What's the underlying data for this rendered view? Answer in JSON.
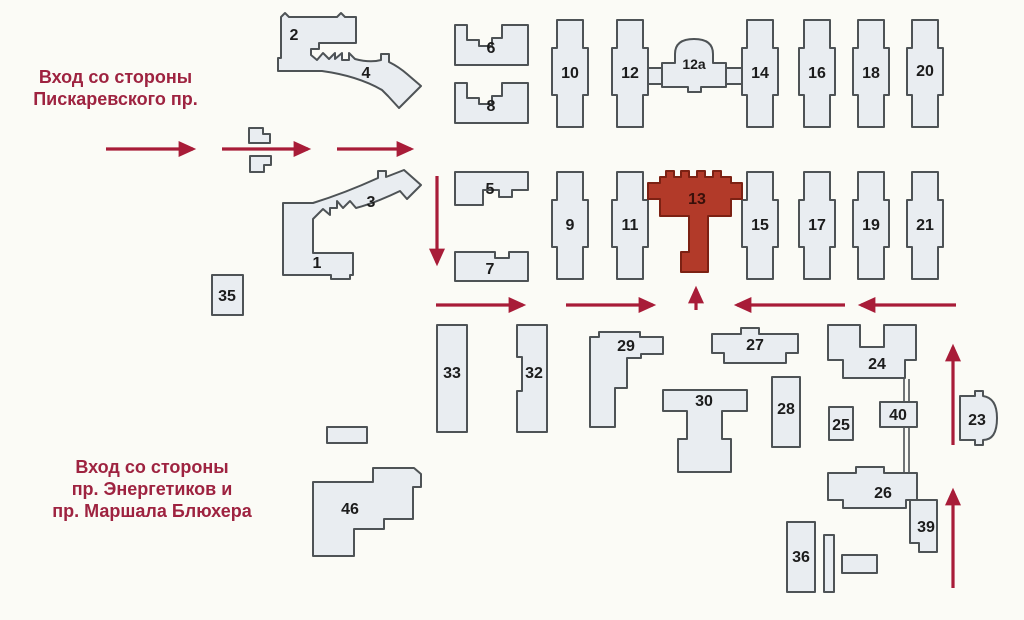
{
  "map_title": "Схема корпусов",
  "highlighted_building": "13",
  "colors": {
    "building_fill": "#e9edf1",
    "building_stroke": "#4e5356",
    "highlight_fill": "#b23a29",
    "highlight_stroke": "#7c2113",
    "arrow_red": "#a81c38",
    "entrance_text_red": "#9e2340",
    "label_black": "#1c1c1c",
    "background": "#fbfbf6"
  },
  "entrance_top": {
    "line1": "Вход со стороны",
    "line2": "Пискаревского пр."
  },
  "entrance_bottom": {
    "line1": "Вход со стороны",
    "line2": "пр. Энергетиков и",
    "line3": "пр. Маршала Блюхера"
  },
  "buildings": {
    "b1": {
      "label": "1"
    },
    "b2": {
      "label": "2"
    },
    "b3": {
      "label": "3"
    },
    "b4": {
      "label": "4"
    },
    "b5": {
      "label": "5"
    },
    "b6": {
      "label": "6"
    },
    "b7": {
      "label": "7"
    },
    "b8": {
      "label": "8"
    },
    "b9": {
      "label": "9"
    },
    "b10": {
      "label": "10"
    },
    "b11": {
      "label": "11"
    },
    "b12": {
      "label": "12"
    },
    "b12a": {
      "label": "12а"
    },
    "b13": {
      "label": "13"
    },
    "b14": {
      "label": "14"
    },
    "b15": {
      "label": "15"
    },
    "b16": {
      "label": "16"
    },
    "b17": {
      "label": "17"
    },
    "b18": {
      "label": "18"
    },
    "b19": {
      "label": "19"
    },
    "b20": {
      "label": "20"
    },
    "b21": {
      "label": "21"
    },
    "b23": {
      "label": "23"
    },
    "b24": {
      "label": "24"
    },
    "b25": {
      "label": "25"
    },
    "b26": {
      "label": "26"
    },
    "b27": {
      "label": "27"
    },
    "b28": {
      "label": "28"
    },
    "b29": {
      "label": "29"
    },
    "b30": {
      "label": "30"
    },
    "b32": {
      "label": "32"
    },
    "b33": {
      "label": "33"
    },
    "b35": {
      "label": "35"
    },
    "b36": {
      "label": "36"
    },
    "b39": {
      "label": "39"
    },
    "b40": {
      "label": "40"
    },
    "b46": {
      "label": "46"
    }
  }
}
